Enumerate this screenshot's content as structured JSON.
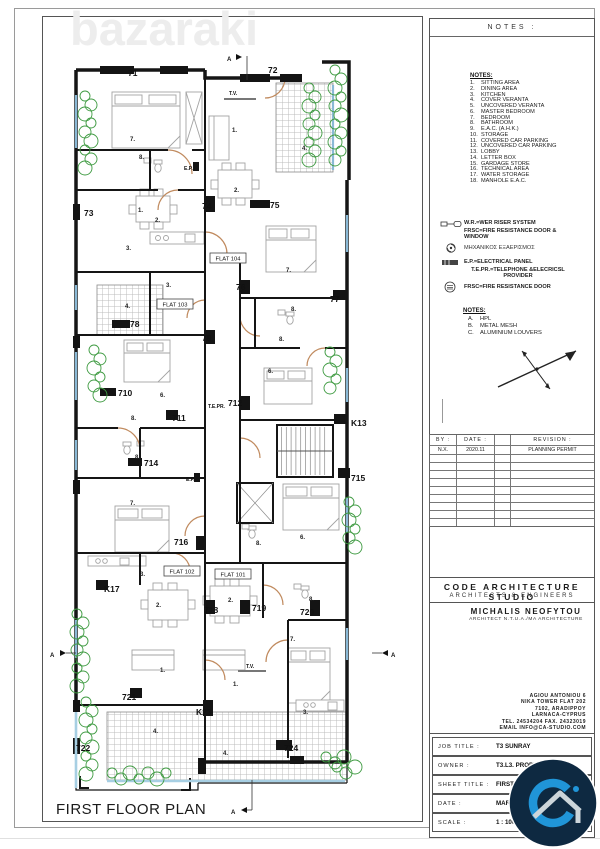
{
  "watermark": "bazaraki",
  "colors": {
    "wall": "#151515",
    "glass_blue": "#8ab9d6",
    "plant_green": "#3f9b42",
    "door_arc": "#c08a5e",
    "logo_navy": "#0e2941",
    "logo_blue": "#2095d8"
  },
  "plan": {
    "title": "FIRST FLOOR PLAN",
    "section_letter": "A",
    "flats": [
      "FLAT 104",
      "FLAT 103",
      "FLAT 102",
      "FLAT 101"
    ],
    "markers": [
      "71",
      "72",
      "73",
      "74",
      "75",
      "76",
      "77",
      "78",
      "79",
      "710",
      "711",
      "712",
      "K13",
      "714",
      "715",
      "716",
      "K17",
      "718",
      "719",
      "720",
      "721",
      "722",
      "K23",
      "724"
    ],
    "room_numbers": {
      "sitting": "1.",
      "dining": "2.",
      "kitchen": "3.",
      "veranda": "4.",
      "master_bedroom": "6.",
      "bedroom": "7.",
      "bathroom": "8."
    },
    "labels": {
      "tv": "T.V.",
      "ep": "E.P.",
      "tepr": "T.E.PR."
    }
  },
  "panel": {
    "header": "NOTES :",
    "notes_title": "NOTES:",
    "notes": [
      "SITTING AREA",
      "DINING AREA",
      "KITCHEN",
      "COVER VERANTA",
      "UNCOVERED VERANTA",
      "MASTER BEDROOM",
      "BEDROOM",
      "BATHROOM",
      "E.A.C. (A.H.K.)",
      "STORAGE",
      "COVERED CAR PARKING",
      "UNCOVERED CAR PARKING",
      "LOBBY",
      "LETTER BOX",
      "GARDAGE STORE",
      "TECHNICAL AREA",
      "WATER STORAGE",
      "MANHOLE E.A.C."
    ],
    "legend": {
      "wr": "W.R.=WER RISER SYSTEM",
      "frsc_window": "FRSC=FIRE RESISTANCE DOOR & WINDOW",
      "fan": "ΜΗΧΑΝΙΚΟΣ ΕΞΑΕΡΙΣΜΟΣ",
      "ep": "E.P.=ELECTRICAL PANEL",
      "tepr": "T.E.PR.=TELEPHONE &ELECRICSL PROVIDER",
      "frsc_door": "FRSC=FIRE RESISTANCE DOOR"
    },
    "materials_title": "NOTES:",
    "materials": [
      {
        "k": "A.",
        "v": "HPL"
      },
      {
        "k": "B.",
        "v": "METAL MESH"
      },
      {
        "k": "C.",
        "v": "ALUMINIUM LOUVERS"
      }
    ],
    "revision": {
      "by_label": "BY :",
      "date_label": "DATE :",
      "rev_label": "REVISION :",
      "by": "N.X.",
      "date": "2020.11",
      "rev": "PLANNING PERMIT",
      "empty_rows": 9
    },
    "studio": {
      "name": "CODE ARCHITECTURE STUDIO",
      "subtitle": "ARCHITECTS & ENGINEERS",
      "architect": "MICHALIS NEOFYTOU",
      "architect_subtitle": "ARCHITECT N.T.U.A./MA ARCHITECTURE"
    },
    "address": [
      "AGIOU ANTONIOU 6",
      "NIKA TOWER FLAT 202",
      "7102, ARADIPPOY",
      "LARNACA-CYPRUS",
      "TEL. 24534204 FAX. 24323019",
      "EMAIL INFO@CA-STUDIO.COM"
    ],
    "project": [
      {
        "label": "JOB TITLE :",
        "value": "T3 SUNRAY"
      },
      {
        "label": "OWNER :",
        "value": "T3.L3. PROPERTIES LTD"
      },
      {
        "label": "SHEET TITLE :",
        "value": "FIRST FLOOR"
      },
      {
        "label": "DATE :",
        "value": "MARCH 20"
      },
      {
        "label": "SCALE :",
        "value": "1 : 100 @"
      }
    ]
  }
}
